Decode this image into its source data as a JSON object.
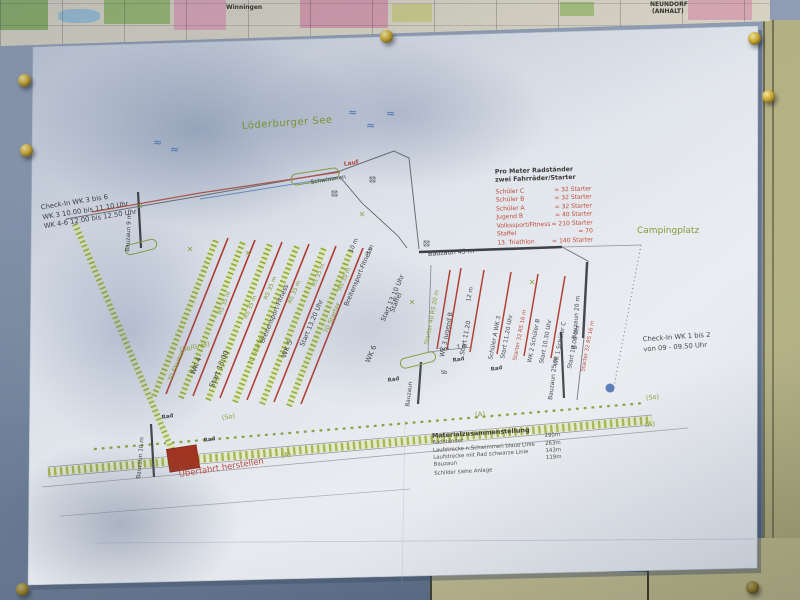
{
  "colors": {
    "paper": "#e2e6ec",
    "board_blue": "#7d8fa8",
    "wall_khaki": "#b3b083",
    "lane_red": "#b0392c",
    "plan_green": "#8fa83a",
    "text_red": "#c04a35",
    "water_blue": "#4a72b8",
    "pin_brass": "#caa933"
  },
  "board": {
    "map_label_left": "Winningen",
    "map_label_right_1": "NEUNDORF",
    "map_label_right_2": "(ANHALT)"
  },
  "plan": {
    "lake": "Löderburger See",
    "campsite": "Campingplatz",
    "run": "Lauf",
    "swim": "Schwimmen",
    "crossing": "Überfahrt herstellen",
    "checkin_left": {
      "l1": "Check-In WK 3 bis 6",
      "l2": "WK 3   10.00 bis 11.10 Uhr",
      "l3": "WK 4-6   12.00 bis 12.50 Uhr"
    },
    "checkin_right": {
      "l1": "Check-In WK 1 bis 2",
      "l2": "von 09 - 09.50 Uhr"
    },
    "legend": {
      "title1": "Pro Meter Radständer",
      "title2": "zwei Fahrräder/Starter",
      "rows": [
        {
          "label": "Schüler C",
          "value": "= 32 Starter"
        },
        {
          "label": "Schüler B",
          "value": "= 32 Starter"
        },
        {
          "label": "Schüler A",
          "value": "= 32 Starter"
        },
        {
          "label": "Jugend B",
          "value": "= 40 Starter"
        },
        {
          "label": "Volkssport/Fitness",
          "value": "= 210 Starter"
        },
        {
          "label": "Staffel",
          "value": "= 70"
        },
        {
          "label": "13. Triathlon",
          "value": "= 140 Starter"
        }
      ]
    },
    "materials": {
      "title": "Materialzusammenstellung",
      "rows": [
        {
          "name": "Radständer",
          "qty": "290m"
        },
        {
          "name": "Laufstrecke n.Schwimmen blaue Linie",
          "qty": "263m"
        },
        {
          "name": "Laufstrecke mit Rad schwarze Linie",
          "qty": "143m"
        },
        {
          "name": "Bauzaun",
          "qty": "119m"
        }
      ],
      "note": "Schilder siehe Anlage"
    },
    "lanes_left": {
      "starter": "70 Starter",
      "wk4": "WK 4",
      "wk4_start": "Start 13.00",
      "wk5": "WK 5",
      "wk5_start": "Start 13.20 Uhr",
      "wk6": "WK 6",
      "wk6_start": "Start 13.10 Uhr",
      "staffel": "Staffel",
      "fitness": "Breitensport-Fitness",
      "rs": "RS 35 m",
      "surface": "(So/Gras)"
    },
    "lanes_right": {
      "starter40": "Starter 40  RS 20 m",
      "wk3": "WK 3 Jugend B",
      "wk3_start": "Start 11.20",
      "schueler_a": "Schüler A  WK 3",
      "a_start": "Start 11.20 Uhr",
      "starter32": "Starter 32  RS 16 m",
      "wk2": "WK 2 Schüler B",
      "wk2_start": "Start 10.30 Uhr",
      "wk1": "WK 1 Schüler C",
      "wk1_start": "Start 10.00 Uhr"
    },
    "fences": {
      "f9": "Bauzaun 9 m",
      "f45": "Bauzaun 45 m",
      "f20": "Bauzaun 20 m",
      "f25": "Bauzaun 25 m",
      "f10": "Bauzaun 10 m",
      "plain": "Bauzaun"
    },
    "dims": {
      "d10": "10 m",
      "d3": "3 m",
      "d7": "7 m",
      "d12": "12 m"
    },
    "misc": {
      "rad": "Rad",
      "a": "(A)",
      "so": "(So)",
      "sb": "Sb",
      "wave": "≈"
    }
  }
}
